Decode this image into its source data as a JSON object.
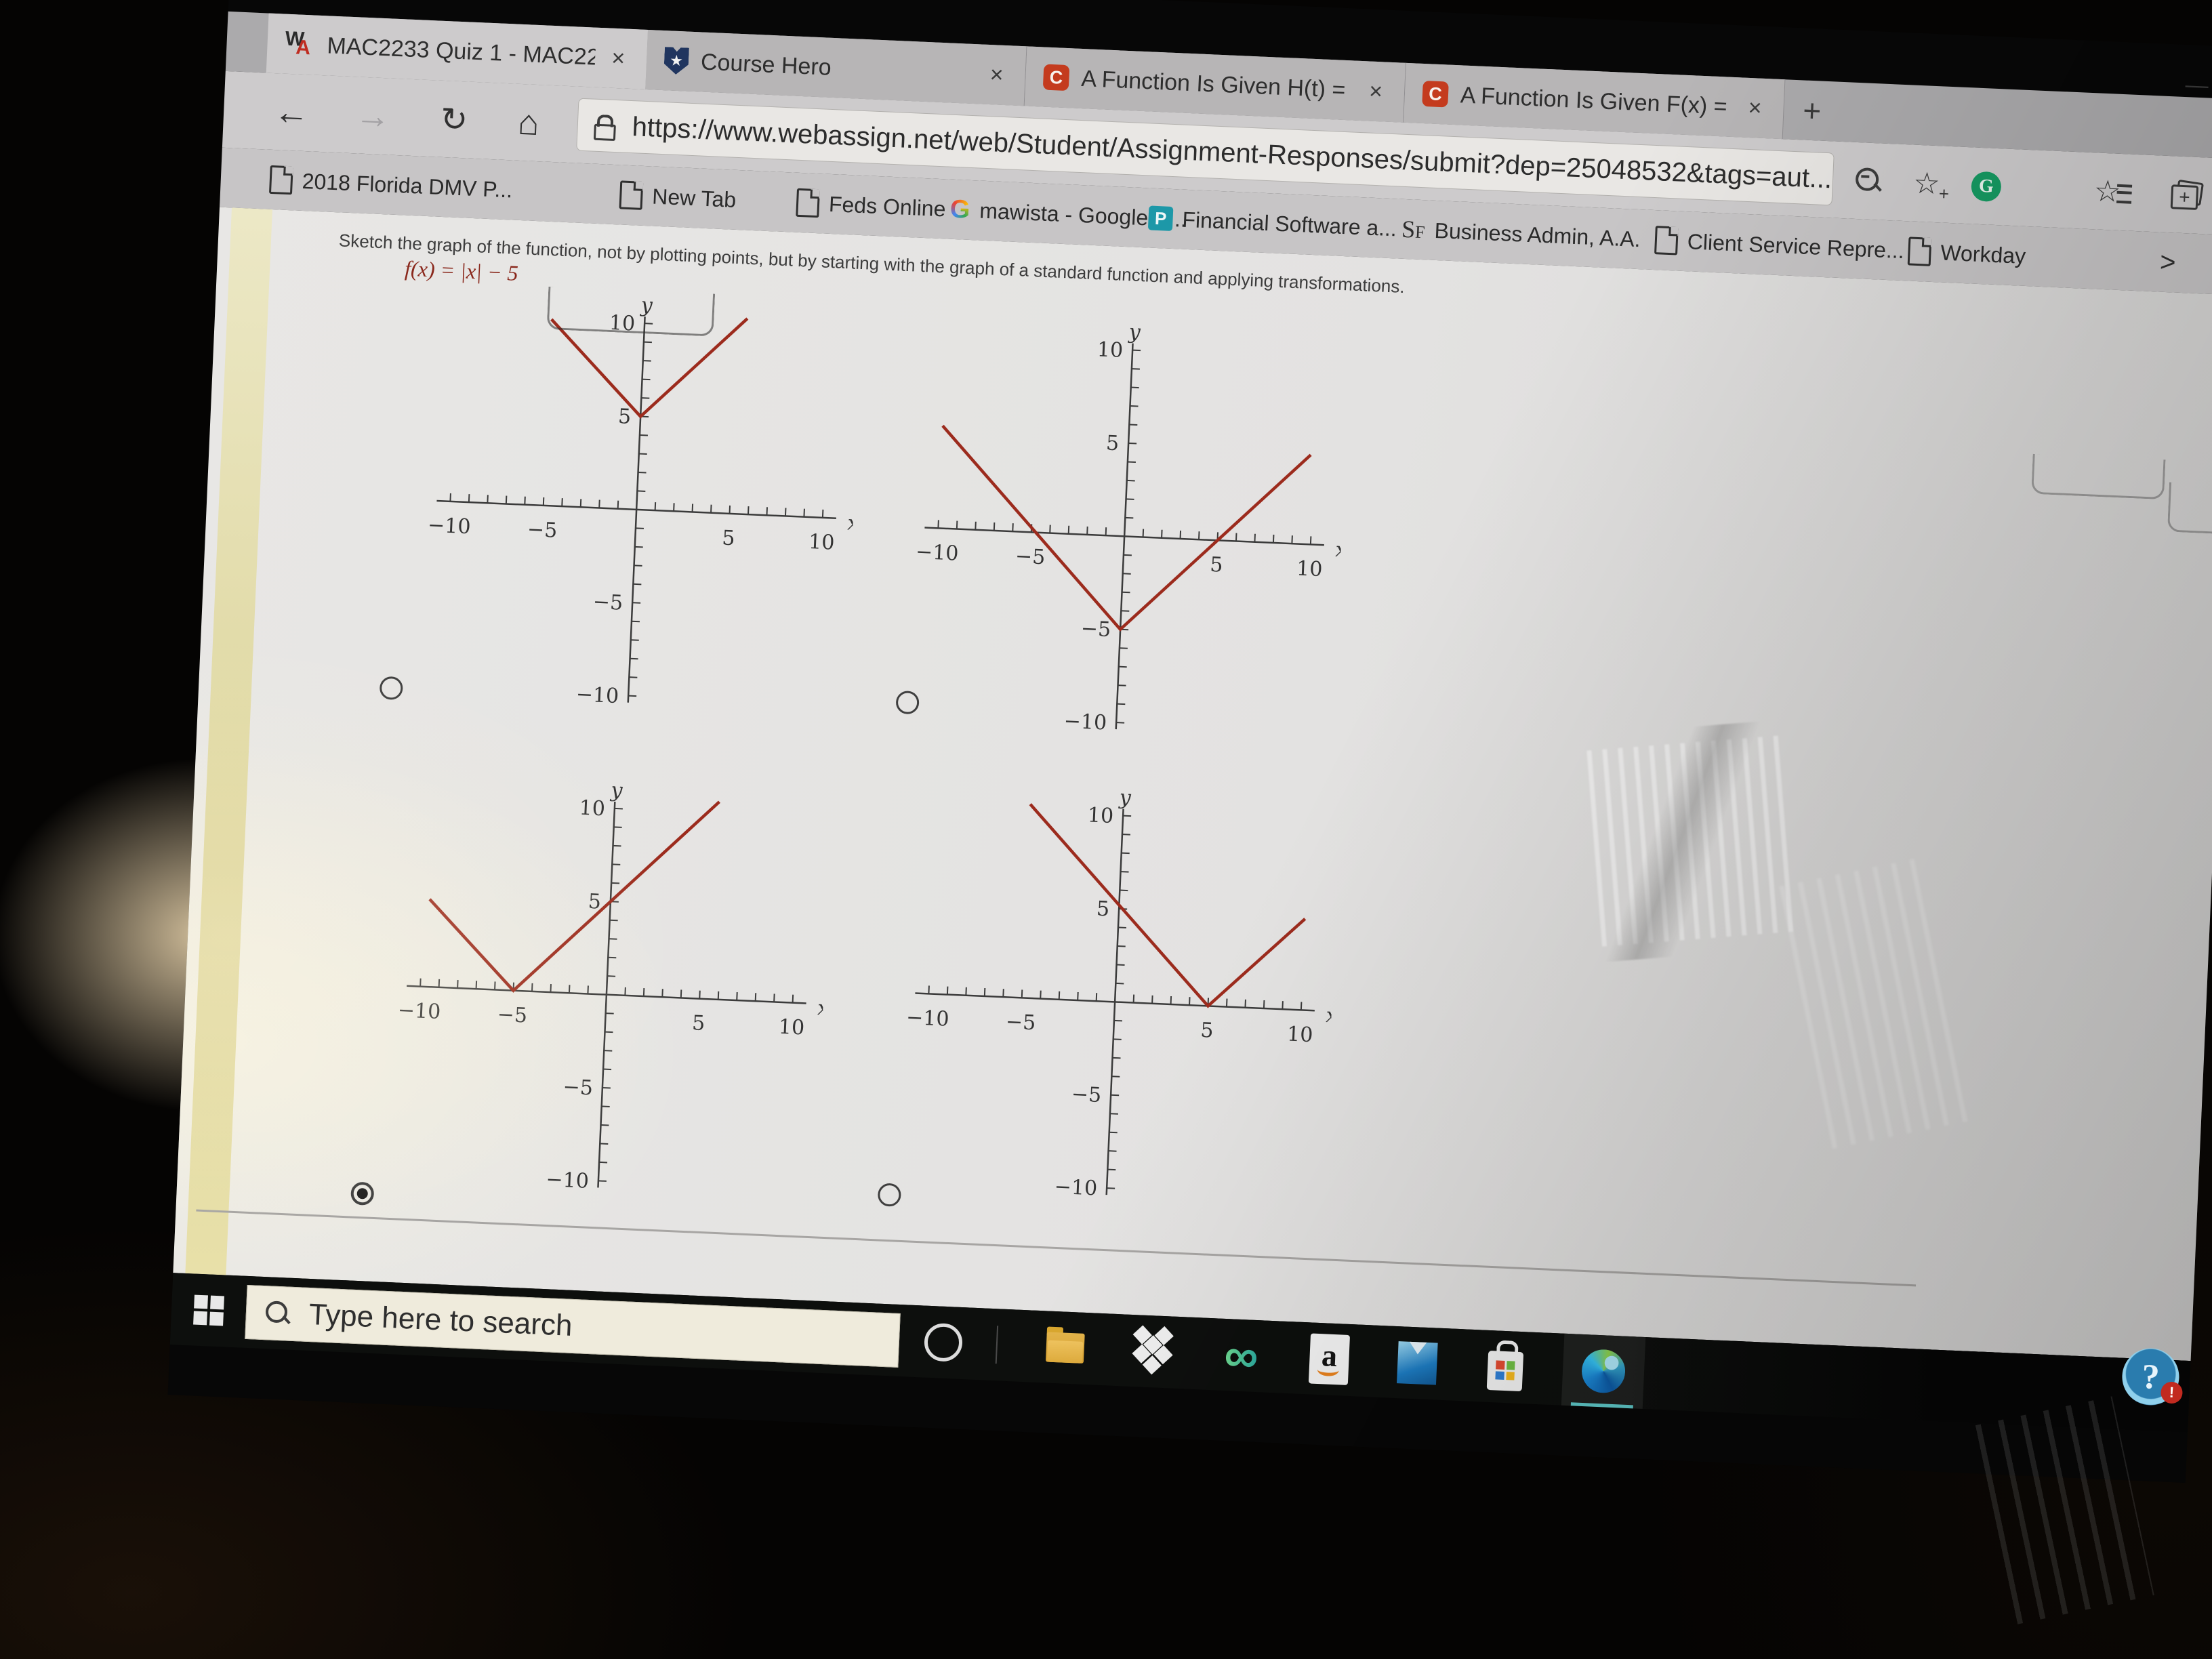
{
  "browser": {
    "tab_bar": {
      "tabs": [
        {
          "title": "MAC2233 Quiz 1 - MAC2233, Fal",
          "favicon": "webassign-icon",
          "close_glyph": "×",
          "active": true
        },
        {
          "title": "Course Hero",
          "favicon": "coursehero-shield-icon",
          "close_glyph": "×",
          "active": false
        },
        {
          "title": "A Function Is Given H(t) = 2t2 −",
          "favicon": "chegg-icon",
          "close_glyph": "×",
          "active": false
        },
        {
          "title": "A Function Is Given F(x) = X3 −",
          "favicon": "chegg-icon",
          "close_glyph": "×",
          "active": false
        }
      ],
      "new_tab_glyph": "+",
      "minimize_glyph": "—"
    },
    "nav_bar": {
      "back_glyph": "←",
      "forward_glyph": "→",
      "refresh_glyph": "↻",
      "home_glyph": "⌂",
      "address": {
        "lock_icon": "lock-icon",
        "url": "https://www.webassign.net/web/Student/Assignment-Responses/submit?dep=25048532&tags=aut..."
      },
      "grammarly_glyph": "G",
      "add_favorite_plus_glyph": "+"
    },
    "bookmarks_bar": {
      "items": [
        {
          "label": "2018 Florida DMV P...",
          "icon": "page-icon"
        },
        {
          "label": "New Tab",
          "icon": "page-icon"
        },
        {
          "label": "Feds Online",
          "icon": "page-icon"
        },
        {
          "label": "mawista - Google S...",
          "icon": "google-g-icon",
          "icon_glyph": "G"
        },
        {
          "label": "Financial Software a...",
          "icon": "p-badge-icon",
          "icon_glyph": "P"
        },
        {
          "label": "Business Admin, A.A.",
          "icon": "sf-text-icon",
          "icon_glyph_main": "S",
          "icon_glyph_small": "F"
        },
        {
          "label": "Client Service Repre...",
          "icon": "page-icon"
        },
        {
          "label": "Workday",
          "icon": "page-icon"
        }
      ],
      "overflow_glyph": ">"
    }
  },
  "page": {
    "question": "Sketch the graph of the function, not by plotting points, but by starting with the graph of a standard function and applying transformations.",
    "function_label": "f(x) = |x| − 5"
  },
  "chart_data": [
    {
      "type": "line",
      "option_index": 0,
      "selected": false,
      "description": "V-shaped absolute value graph with vertex (0, 5): y = |x| + 5",
      "vertex": [
        0,
        5
      ],
      "points": [
        [
          -5,
          10
        ],
        [
          0,
          5
        ],
        [
          5.5,
          10.5
        ]
      ],
      "xlabel": "x",
      "ylabel": "y",
      "xlim": [
        -10.8,
        10.8
      ],
      "ylim": [
        -10.5,
        10.5
      ],
      "xticks": [
        -10,
        -5,
        5,
        10
      ],
      "yticks": [
        -10,
        -5,
        5,
        10
      ],
      "minor_tick_step": 1,
      "line_color": "#9c2b1d",
      "grid": false
    },
    {
      "type": "line",
      "option_index": 1,
      "selected": false,
      "description": "V-shaped absolute value graph with vertex (0, -5): y = |x| − 5",
      "vertex": [
        0,
        -5
      ],
      "points": [
        [
          -10,
          5.5
        ],
        [
          0,
          -5
        ],
        [
          9.8,
          4.8
        ]
      ],
      "xlabel": "x",
      "ylabel": "y",
      "xlim": [
        -10.8,
        10.8
      ],
      "ylim": [
        -10.5,
        10.5
      ],
      "xticks": [
        -10,
        -5,
        5,
        10
      ],
      "yticks": [
        -10,
        -5,
        5,
        10
      ],
      "minor_tick_step": 1,
      "line_color": "#9c2b1d",
      "grid": false
    },
    {
      "type": "line",
      "option_index": 2,
      "selected": true,
      "description": "V-shaped absolute value graph with vertex (-5, 0): y = |x + 5|",
      "vertex": [
        -5,
        0
      ],
      "points": [
        [
          -9.7,
          4.7
        ],
        [
          -5,
          0
        ],
        [
          5.6,
          10.6
        ]
      ],
      "xlabel": "x",
      "ylabel": "y",
      "xlim": [
        -10.8,
        10.8
      ],
      "ylim": [
        -10.5,
        10.5
      ],
      "xticks": [
        -10,
        -5,
        5,
        10
      ],
      "yticks": [
        -10,
        -5,
        5,
        10
      ],
      "minor_tick_step": 1,
      "line_color": "#9c2b1d",
      "grid": false
    },
    {
      "type": "line",
      "option_index": 3,
      "selected": false,
      "description": "V-shaped absolute value graph with vertex (5, 0): y = |x − 5|",
      "vertex": [
        5,
        0
      ],
      "points": [
        [
          -5,
          10.4
        ],
        [
          5,
          0
        ],
        [
          10,
          4.9
        ]
      ],
      "xlabel": "x",
      "ylabel": "y",
      "xlim": [
        -10.8,
        10.8
      ],
      "ylim": [
        -10.5,
        10.5
      ],
      "xticks": [
        -10,
        -5,
        5,
        10
      ],
      "yticks": [
        -10,
        -5,
        5,
        10
      ],
      "minor_tick_step": 1,
      "line_color": "#9c2b1d",
      "grid": false
    }
  ],
  "taskbar": {
    "start_icon": "windows-start-icon",
    "search": {
      "icon": "search-icon",
      "placeholder": "Type here to search"
    },
    "icons": [
      "cortana-icon",
      "file-explorer-icon",
      "dropbox-icon",
      "infinity-icon",
      "amazon-icon",
      "mail-icon",
      "microsoft-store-icon",
      "edge-icon"
    ],
    "active_app": "edge"
  },
  "help_button": {
    "glyph": "?",
    "badge_glyph": "!"
  },
  "colors": {
    "line_red": "#9c2b1d",
    "page_bg": "#e5e4e2",
    "chrome_bg": "#cdcbcc",
    "tab_strip": "#abaaac",
    "bookmarks_bg": "#c7c5c6",
    "taskbar_bg": "#0d0f0d",
    "yellow_band": "#ddd59b",
    "chegg_orange": "#c43b1e",
    "coursehero_navy": "#20355f",
    "grammarly_green": "#169a62",
    "help_blue": "#2f86b8"
  }
}
